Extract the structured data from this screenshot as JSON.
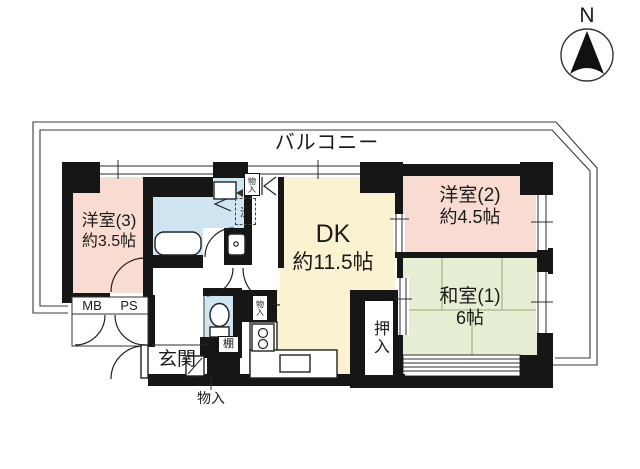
{
  "compass": {
    "north_label": "N"
  },
  "balcony": {
    "label": "バルコニー"
  },
  "rooms": {
    "dk": {
      "name": "DK",
      "size": "約11.5帖"
    },
    "western2": {
      "name": "洋室(2)",
      "size": "約4.5帖"
    },
    "western3": {
      "name": "洋室(3)",
      "size": "約3.5帖"
    },
    "japanese1": {
      "name": "和室(1)",
      "size": "6帖"
    },
    "entrance": {
      "label": "玄関"
    },
    "closet_oshiire": {
      "label": "押入"
    }
  },
  "small_labels": {
    "meter_box": "MB",
    "pipe_space": "PS",
    "shelf": "棚",
    "laundry": "洗",
    "storage_top": "物入",
    "storage_kitchen": "物入",
    "storage_entrance": "物入"
  },
  "colors": {
    "wall": "#161616",
    "western_room_pink": "#f8dcd2",
    "dk_cream": "#fbf2d1",
    "japanese_room_green": "#e6eed3",
    "wet_area_blue": "#cfe6f2",
    "outline": "#3a3a3a"
  }
}
